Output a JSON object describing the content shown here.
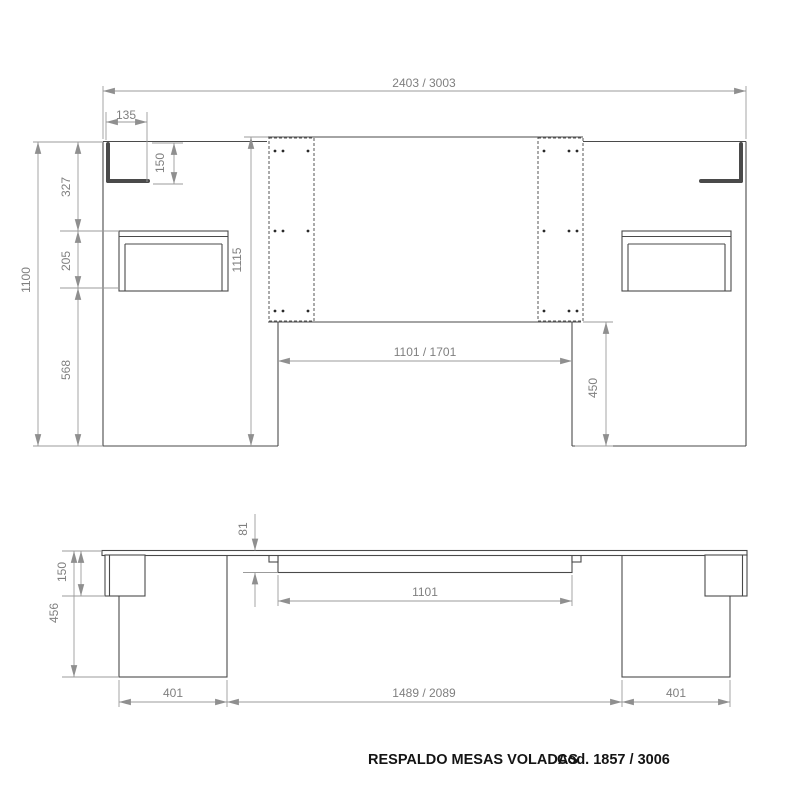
{
  "title_block": {
    "name": "RESPALDO MESAS VOLADAS",
    "code": "Cod. 1857 / 3006"
  },
  "colors": {
    "background": "#ffffff",
    "object_line": "#4a4a4a",
    "dimension_line": "#9b9b9b",
    "dimension_text": "#7f7f7f",
    "title_text": "#141414"
  },
  "front_view": {
    "dims": {
      "total_width": "2403 / 3003",
      "shelf_width": "135",
      "shelf_drop": "150",
      "seg_upper": "327",
      "seg_table": "205",
      "seg_lower": "568",
      "total_height": "1100",
      "center_panel_height": "1115",
      "cutout_width": "1101 / 1701",
      "cutout_height": "450"
    }
  },
  "plan_view": {
    "dims": {
      "batten_depth": "81",
      "batten_width": "1101",
      "shelf_depth": "150",
      "table_depth": "456",
      "left_table_width": "401",
      "center_span": "1489 / 2089",
      "right_table_width": "401"
    }
  }
}
